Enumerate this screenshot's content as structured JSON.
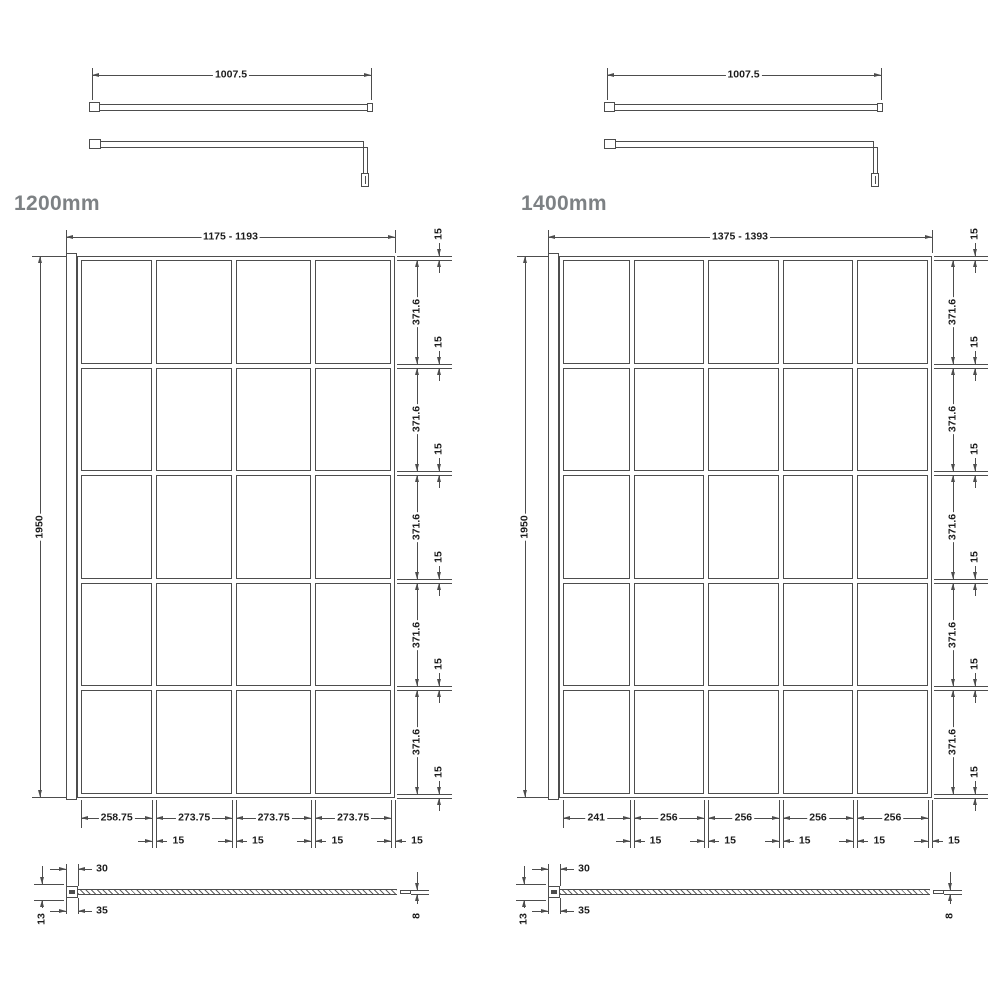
{
  "colors": {
    "line": "#4d4d4d",
    "dim_text": "#1c1c1c",
    "title_text": "#7d8184",
    "background": "#ffffff"
  },
  "diagrams": [
    {
      "label": "1200mm",
      "bar_dim": "1007.5",
      "width_dim": "1175 - 1193",
      "height_dim": "1950",
      "row_dims": [
        "371.6",
        "371.6",
        "371.6",
        "371.6",
        "371.6"
      ],
      "row_gap_dims": [
        "15",
        "15",
        "15",
        "15",
        "15",
        "15"
      ],
      "col_dims": [
        "258.75",
        "273.75",
        "273.75",
        "273.75"
      ],
      "col_gap_dims": [
        "15",
        "15",
        "15",
        "15"
      ],
      "grid": {
        "rows": 5,
        "columns": 4
      },
      "section": {
        "width_top": "30",
        "width_bottom": "35",
        "thickness_left": "13",
        "thickness_right": "8"
      }
    },
    {
      "label": "1400mm",
      "bar_dim": "1007.5",
      "width_dim": "1375 - 1393",
      "height_dim": "1950",
      "row_dims": [
        "371.6",
        "371.6",
        "371.6",
        "371.6",
        "371.6"
      ],
      "row_gap_dims": [
        "15",
        "15",
        "15",
        "15",
        "15",
        "15"
      ],
      "col_dims": [
        "241",
        "256",
        "256",
        "256",
        "256"
      ],
      "col_gap_dims": [
        "15",
        "15",
        "15",
        "15",
        "15"
      ],
      "grid": {
        "rows": 5,
        "columns": 5
      },
      "section": {
        "width_top": "30",
        "width_bottom": "35",
        "thickness_left": "13",
        "thickness_right": "8"
      }
    }
  ]
}
